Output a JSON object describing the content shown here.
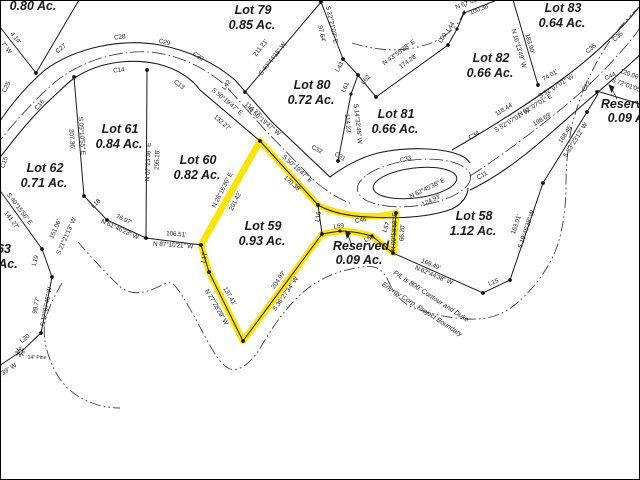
{
  "map": {
    "background_color": "#ffffff",
    "line_color": "#1b1b1b",
    "highlight_color": "#ffe400",
    "contour_color": "#404040",
    "highlighted_parcel": {
      "name": "Lot 59",
      "acreage": "0.93 Ac."
    },
    "parcels": [
      {
        "name": "(partial)",
        "acreage": "0.80 Ac."
      },
      {
        "name": "Lot 79",
        "acreage": "0.85 Ac."
      },
      {
        "name": "Lot 80",
        "acreage": "0.72 Ac."
      },
      {
        "name": "Lot 81",
        "acreage": "0.66 Ac."
      },
      {
        "name": "Lot 82",
        "acreage": "0.66 Ac."
      },
      {
        "name": "Lot 83",
        "acreage": "0.64 Ac."
      },
      {
        "name": "Lot 61",
        "acreage": "0.84 Ac."
      },
      {
        "name": "Lot 62",
        "acreage": "0.71 Ac."
      },
      {
        "name": "Lot 63 (partial)",
        "acreage": ""
      },
      {
        "name": "Lot 60",
        "acreage": "0.82 Ac."
      },
      {
        "name": "Lot 59",
        "acreage": "0.93 Ac."
      },
      {
        "name": "Lot 58",
        "acreage": "1.12 Ac."
      },
      {
        "name": "Reserved",
        "acreage": "0.09 Ac."
      },
      {
        "name": "Reserved",
        "acreage": "0.09 Ac."
      }
    ],
    "boundary_note_line1": "P/L is 800' Contour and Duke",
    "boundary_note_line2": "Energy Corp. Project Boundary",
    "tree_label": "14\" Pine"
  },
  "labels": [
    {
      "n": "lot-78-acreage",
      "t": "0.80 Ac.",
      "x": 33,
      "y": 10,
      "r": 0,
      "c": "lot"
    },
    {
      "n": "lot-79-name",
      "t": "Lot 79",
      "x": 253,
      "y": 14,
      "r": 0,
      "c": "lot"
    },
    {
      "n": "lot-79-acreage",
      "t": "0.85 Ac.",
      "x": 252,
      "y": 29,
      "r": 0,
      "c": "lot"
    },
    {
      "n": "lot-80-name",
      "t": "Lot 80",
      "x": 312,
      "y": 89,
      "r": 0,
      "c": "lot"
    },
    {
      "n": "lot-80-acreage",
      "t": "0.72 Ac.",
      "x": 311,
      "y": 104,
      "r": 0,
      "c": "lot"
    },
    {
      "n": "lot-81-name",
      "t": "Lot 81",
      "x": 396,
      "y": 118,
      "r": 0,
      "c": "lot"
    },
    {
      "n": "lot-81-acreage",
      "t": "0.66 Ac.",
      "x": 395,
      "y": 133,
      "r": 0,
      "c": "lot"
    },
    {
      "n": "lot-82-name",
      "t": "Lot 82",
      "x": 491,
      "y": 62,
      "r": 0,
      "c": "lot"
    },
    {
      "n": "lot-82-acreage",
      "t": "0.66 Ac.",
      "x": 490,
      "y": 77,
      "r": 0,
      "c": "lot"
    },
    {
      "n": "lot-83-name",
      "t": "Lot 83",
      "x": 563,
      "y": 12,
      "r": 0,
      "c": "lot"
    },
    {
      "n": "lot-83-acreage",
      "t": "0.64 Ac.",
      "x": 562,
      "y": 27,
      "r": 0,
      "c": "lot"
    },
    {
      "n": "lot-61-name",
      "t": "Lot 61",
      "x": 120,
      "y": 133,
      "r": 0,
      "c": "lot"
    },
    {
      "n": "lot-61-acreage",
      "t": "0.84 Ac.",
      "x": 119,
      "y": 148,
      "r": 0,
      "c": "lot"
    },
    {
      "n": "lot-62-name",
      "t": "Lot 62",
      "x": 45,
      "y": 172,
      "r": 0,
      "c": "lot"
    },
    {
      "n": "lot-62-acreage",
      "t": "0.71 Ac.",
      "x": 44,
      "y": 187,
      "r": 0,
      "c": "lot"
    },
    {
      "n": "lot-63-name-partial",
      "t": "63",
      "x": 4,
      "y": 253,
      "r": 0,
      "c": "lot"
    },
    {
      "n": "lot-63-acreage-partial",
      "t": "Ac.",
      "x": 8,
      "y": 268,
      "r": 0,
      "c": "lot"
    },
    {
      "n": "lot-60-name",
      "t": "Lot 60",
      "x": 198,
      "y": 164,
      "r": 0,
      "c": "lot"
    },
    {
      "n": "lot-60-acreage",
      "t": "0.82 Ac.",
      "x": 197,
      "y": 179,
      "r": 0,
      "c": "lot"
    },
    {
      "n": "lot-59-name",
      "t": "Lot 59",
      "x": 263,
      "y": 230,
      "r": 0,
      "c": "lot"
    },
    {
      "n": "lot-59-acreage",
      "t": "0.93 Ac.",
      "x": 262,
      "y": 245,
      "r": 0,
      "c": "lot"
    },
    {
      "n": "lot-58-name",
      "t": "Lot 58",
      "x": 474,
      "y": 220,
      "r": 0,
      "c": "lot"
    },
    {
      "n": "lot-58-acreage",
      "t": "1.12 Ac.",
      "x": 473,
      "y": 235,
      "r": 0,
      "c": "lot"
    },
    {
      "n": "reserved-center-name",
      "t": "Reserved",
      "x": 361,
      "y": 250,
      "r": 0,
      "c": "lot"
    },
    {
      "n": "reserved-center-acreage",
      "t": "0.09 Ac.",
      "x": 359,
      "y": 264,
      "r": 0,
      "c": "lot"
    },
    {
      "n": "reserved-right-name",
      "t": "Reserved",
      "x": 629,
      "y": 108,
      "r": 0,
      "c": "lot"
    },
    {
      "n": "reserved-right-acreage",
      "t": "0.09 Ac.",
      "x": 631,
      "y": 122,
      "r": 0,
      "c": "lot"
    },
    {
      "n": "curve-ref-c25",
      "t": "C25",
      "x": 8,
      "y": 88,
      "r": -62,
      "c": "sm"
    },
    {
      "n": "curve-ref-c27",
      "t": "C27",
      "x": 62,
      "y": 50,
      "r": -38,
      "c": "sm"
    },
    {
      "n": "curve-ref-c28",
      "t": "C28",
      "x": 120,
      "y": 39,
      "r": -8,
      "c": "sm"
    },
    {
      "n": "curve-ref-c29",
      "t": "C29",
      "x": 164,
      "y": 44,
      "r": 14,
      "c": "sm"
    },
    {
      "n": "curve-ref-c30",
      "t": "C30",
      "x": 197,
      "y": 58,
      "r": 33,
      "c": "sm"
    },
    {
      "n": "curve-ref-c16",
      "t": "C16",
      "x": 41,
      "y": 106,
      "r": -52,
      "c": "sm"
    },
    {
      "n": "curve-ref-c14",
      "t": "C14",
      "x": 119,
      "y": 72,
      "r": -6,
      "c": "sm"
    },
    {
      "n": "curve-ref-c13",
      "t": "C13",
      "x": 178,
      "y": 86,
      "r": 38,
      "c": "sm"
    },
    {
      "n": "curve-ref-c15",
      "t": "C15",
      "x": 6,
      "y": 163,
      "r": -72,
      "c": "sm"
    },
    {
      "n": "curve-ref-c32",
      "t": "C32",
      "x": 316,
      "y": 151,
      "r": 28,
      "c": "sm"
    },
    {
      "n": "curve-ref-c31",
      "t": "C31",
      "x": 339,
      "y": 158,
      "r": 32,
      "c": "sm"
    },
    {
      "n": "curve-ref-c33",
      "t": "C33",
      "x": 406,
      "y": 161,
      "r": -14,
      "c": "sm"
    },
    {
      "n": "curve-ref-c34",
      "t": "C34",
      "x": 475,
      "y": 137,
      "r": -32,
      "c": "sm"
    },
    {
      "n": "curve-ref-c35",
      "t": "C35",
      "x": 592,
      "y": 50,
      "r": -40,
      "c": "sm"
    },
    {
      "n": "curve-ref-c36",
      "t": "C36",
      "x": 619,
      "y": 38,
      "r": -42,
      "c": "sm"
    },
    {
      "n": "curve-ref-c11",
      "t": "C11",
      "x": 483,
      "y": 177,
      "r": -30,
      "c": "sm"
    },
    {
      "n": "curve-ref-c12",
      "t": "C12",
      "x": 588,
      "y": 87,
      "r": -58,
      "c": "sm"
    },
    {
      "n": "curve-ref-c44",
      "t": "C44",
      "x": 611,
      "y": 78,
      "r": -25,
      "c": "sm"
    },
    {
      "n": "curve-ref-c46",
      "t": "C46",
      "x": 361,
      "y": 222,
      "r": -10,
      "c": "sm"
    },
    {
      "n": "line-ref-l42",
      "t": "L42",
      "x": 228,
      "y": 86,
      "r": -55,
      "c": "sm"
    },
    {
      "n": "line-ref-l43",
      "t": "L43",
      "x": 341,
      "y": 68,
      "r": -58,
      "c": "sm"
    },
    {
      "n": "line-ref-l61",
      "t": "L61",
      "x": 347,
      "y": 88,
      "r": -68,
      "c": "sm"
    },
    {
      "n": "line-ref-l62",
      "t": "L62",
      "x": 367,
      "y": 81,
      "r": -48,
      "c": "sm"
    },
    {
      "n": "line-ref-l60",
      "t": "L60",
      "x": 444,
      "y": 39,
      "r": -58,
      "c": "sm"
    },
    {
      "n": "line-ref-l44",
      "t": "L44",
      "x": 452,
      "y": 28,
      "r": -58,
      "c": "sm"
    },
    {
      "n": "line-ref-l16",
      "t": "L16",
      "x": 320,
      "y": 217,
      "r": -80,
      "c": "sm"
    },
    {
      "n": "line-ref-l59",
      "t": "L59",
      "x": 339,
      "y": 228,
      "r": -8,
      "c": "sm"
    },
    {
      "n": "line-ref-l58",
      "t": "L58",
      "x": 370,
      "y": 240,
      "r": -28,
      "c": "sm"
    },
    {
      "n": "line-ref-l57",
      "t": "L57",
      "x": 388,
      "y": 228,
      "r": -68,
      "c": "sm"
    },
    {
      "n": "line-ref-l15",
      "t": "L15",
      "x": 494,
      "y": 284,
      "r": -22,
      "c": "sm"
    },
    {
      "n": "line-ref-l17",
      "t": "L17",
      "x": 206,
      "y": 258,
      "r": -80,
      "c": "sm"
    },
    {
      "n": "line-ref-l18",
      "t": "L18",
      "x": 97,
      "y": 205,
      "r": -42,
      "c": "sm"
    },
    {
      "n": "line-ref-l19",
      "t": "L19",
      "x": 37,
      "y": 261,
      "r": -74,
      "c": "sm"
    },
    {
      "n": "line-ref-l20",
      "t": "L20",
      "x": 26,
      "y": 340,
      "r": -38,
      "c": "sm"
    },
    {
      "n": "bearing",
      "t": "S 05°10'55\" E",
      "x": 80,
      "y": 136,
      "r": 86,
      "c": "sm"
    },
    {
      "n": "distance",
      "t": "207.36'",
      "x": 70,
      "y": 139,
      "r": 86,
      "c": "sm"
    },
    {
      "n": "bearing",
      "t": "N 07°23'38\" E",
      "x": 150,
      "y": 162,
      "r": -88,
      "c": "sm"
    },
    {
      "n": "distance",
      "t": "295.18'",
      "x": 159,
      "y": 160,
      "r": -88,
      "c": "sm"
    },
    {
      "n": "distance",
      "t": "211.21'",
      "x": 262,
      "y": 49,
      "r": -52,
      "c": "sm"
    },
    {
      "n": "bearing",
      "t": "S 40°44'15\" W",
      "x": 274,
      "y": 60,
      "r": -52,
      "c": "sm"
    },
    {
      "n": "distance",
      "t": "97.64'",
      "x": 320,
      "y": 34,
      "r": 78,
      "c": "sm"
    },
    {
      "n": "bearing",
      "t": "S 22°21'07\" E",
      "x": 330,
      "y": 25,
      "r": 78,
      "c": "sm"
    },
    {
      "n": "bearing",
      "t": "N 43°55'38\" E",
      "x": 400,
      "y": 54,
      "r": -36,
      "c": "sm"
    },
    {
      "n": "distance",
      "t": "174.28'",
      "x": 409,
      "y": 63,
      "r": -36,
      "c": "sm"
    },
    {
      "n": "distance",
      "t": "114.23'",
      "x": 346,
      "y": 124,
      "r": 84,
      "c": "sm"
    },
    {
      "n": "bearing",
      "t": "S 14°32'46\" W",
      "x": 356,
      "y": 124,
      "r": 84,
      "c": "sm"
    },
    {
      "n": "bearing",
      "t": "S 50°19'47\" E",
      "x": 226,
      "y": 103,
      "r": 40,
      "c": "sm"
    },
    {
      "n": "distance",
      "t": "132.27'",
      "x": 221,
      "y": 124,
      "r": 40,
      "c": "sm"
    },
    {
      "n": "distance",
      "t": "114.77'",
      "x": 252,
      "y": 111,
      "r": 40,
      "c": "sm"
    },
    {
      "n": "bearing",
      "t": "N 50°19'47\" W",
      "x": 263,
      "y": 123,
      "r": 40,
      "c": "sm"
    },
    {
      "n": "bearing",
      "t": "S 50°19'47\" E",
      "x": 296,
      "y": 170,
      "r": 42,
      "c": "sm"
    },
    {
      "n": "distance",
      "t": "170.38'",
      "x": 291,
      "y": 185,
      "r": 42,
      "c": "sm"
    },
    {
      "n": "bearing",
      "t": "N 26°16'36\" E",
      "x": 224,
      "y": 191,
      "r": -63,
      "c": "sm"
    },
    {
      "n": "distance",
      "t": "201.42'",
      "x": 237,
      "y": 202,
      "r": -63,
      "c": "sm"
    },
    {
      "n": "distance",
      "t": "137.41'",
      "x": 228,
      "y": 297,
      "r": 60,
      "c": "sm"
    },
    {
      "n": "bearing",
      "t": "N 27°28'29\" W",
      "x": 215,
      "y": 308,
      "r": 60,
      "c": "sm"
    },
    {
      "n": "distance",
      "t": "204.97'",
      "x": 280,
      "y": 281,
      "r": -55,
      "c": "sm"
    },
    {
      "n": "bearing",
      "t": "S 36°27'34\" W",
      "x": 287,
      "y": 295,
      "r": -55,
      "c": "sm"
    },
    {
      "n": "distance",
      "t": "169.49'",
      "x": 430,
      "y": 266,
      "r": 23,
      "c": "sm"
    },
    {
      "n": "bearing",
      "t": "N 62°44'38\" W",
      "x": 433,
      "y": 277,
      "r": 23,
      "c": "sm"
    },
    {
      "n": "bearing",
      "t": "N 00°58'58\" E",
      "x": 396,
      "y": 232,
      "r": -87,
      "c": "sm"
    },
    {
      "n": "distance",
      "t": "66.20'",
      "x": 404,
      "y": 233,
      "r": -87,
      "c": "sm"
    },
    {
      "n": "bearing",
      "t": "N 62°45'38\" E",
      "x": 428,
      "y": 190,
      "r": -26,
      "c": "sm"
    },
    {
      "n": "distance",
      "t": "124.93'",
      "x": 432,
      "y": 202,
      "r": -26,
      "c": "sm"
    },
    {
      "n": "distance",
      "t": "163.01'",
      "x": 518,
      "y": 225,
      "r": -71,
      "c": "sm"
    },
    {
      "n": "bearing",
      "t": "S 19°45'38\" W",
      "x": 528,
      "y": 230,
      "r": -71,
      "c": "sm"
    },
    {
      "n": "distance",
      "t": "168.45'",
      "x": 567,
      "y": 135,
      "r": -58,
      "c": "sm"
    },
    {
      "n": "bearing",
      "t": "S 33°23'12\" W",
      "x": 577,
      "y": 141,
      "r": -58,
      "c": "sm"
    },
    {
      "n": "distance",
      "t": "118.44'",
      "x": 505,
      "y": 111,
      "r": -31,
      "c": "sm"
    },
    {
      "n": "bearing",
      "t": "S 52°07'01\" W",
      "x": 513,
      "y": 122,
      "r": -31,
      "c": "sm"
    },
    {
      "n": "bearing",
      "t": "N 52°07'01\" E",
      "x": 536,
      "y": 107,
      "r": -31,
      "c": "sm"
    },
    {
      "n": "distance",
      "t": "198.69'",
      "x": 543,
      "y": 121,
      "r": -31,
      "c": "sm"
    },
    {
      "n": "distance",
      "t": "74.01'",
      "x": 551,
      "y": 77,
      "r": -31,
      "c": "sm"
    },
    {
      "n": "bearing",
      "t": "S 52°07'01\" W",
      "x": 557,
      "y": 88,
      "r": -31,
      "c": "sm"
    },
    {
      "n": "distance",
      "t": "120.06'",
      "x": 629,
      "y": 76,
      "r": 20,
      "c": "sm"
    },
    {
      "n": "bearing",
      "t": "S 72°01'05\" E",
      "x": 629,
      "y": 88,
      "r": 20,
      "c": "sm"
    },
    {
      "n": "distance",
      "t": "183.90'",
      "x": 528,
      "y": 44,
      "r": 74,
      "c": "sm"
    },
    {
      "n": "bearing",
      "t": "N 16°13'49\" W",
      "x": 517,
      "y": 49,
      "r": 74,
      "c": "sm"
    },
    {
      "n": "distance",
      "t": "100.38'",
      "x": 480,
      "y": 11,
      "r": -21,
      "c": "sm"
    },
    {
      "n": "bearing",
      "t": "N 67°05' E",
      "x": 470,
      "y": 4,
      "r": -21,
      "c": "sm"
    },
    {
      "n": "distance",
      "t": "106.51'",
      "x": 176,
      "y": 236,
      "r": 4,
      "c": "sm"
    },
    {
      "n": "bearing",
      "t": "N 87°10'21\" W",
      "x": 173,
      "y": 247,
      "r": 4,
      "c": "sm"
    },
    {
      "n": "distance",
      "t": "76.97'",
      "x": 123,
      "y": 221,
      "r": 25,
      "c": "sm"
    },
    {
      "n": "bearing",
      "t": "N 61°46'23\" W",
      "x": 119,
      "y": 231,
      "r": 25,
      "c": "sm"
    },
    {
      "n": "distance",
      "t": "151.06'",
      "x": 57,
      "y": 230,
      "r": -66,
      "c": "sm"
    },
    {
      "n": "bearing",
      "t": "S 21°21'13\" W",
      "x": 68,
      "y": 237,
      "r": -66,
      "c": "sm"
    },
    {
      "n": "bearing",
      "t": "S 40°15'56\" E",
      "x": 18,
      "y": 210,
      "r": 53,
      "c": "sm"
    },
    {
      "n": "distance",
      "t": "141.27'",
      "x": 10,
      "y": 221,
      "r": 53,
      "c": "sm"
    },
    {
      "n": "distance",
      "t": "99.77'",
      "x": 38,
      "y": 306,
      "r": -79,
      "c": "sm"
    },
    {
      "n": "bearing",
      "t": "S 12°07'45\" W",
      "x": 48,
      "y": 307,
      "r": -79,
      "c": "sm"
    },
    {
      "n": "distance-partial",
      "t": "4.14'",
      "x": 14,
      "y": 39,
      "r": 51,
      "c": "sm"
    },
    {
      "n": "bearing-partial",
      "t": "7\" W",
      "x": 5,
      "y": 49,
      "r": 51,
      "c": "sm"
    },
    {
      "n": "bearing-partial",
      "t": "4'39\" W",
      "x": 8,
      "y": 372,
      "r": -33,
      "c": "sm"
    },
    {
      "n": "tree-label",
      "t": "14\" Pine",
      "x": 37,
      "y": 359,
      "r": 0,
      "c": "tiny"
    },
    {
      "n": "boundary-note-line1",
      "t": "P/L is 800' Contour and Duke",
      "x": 430,
      "y": 298,
      "r": 33,
      "c": "pl"
    },
    {
      "n": "boundary-note-line2",
      "t": "Energy Corp. Project Boundary",
      "x": 421,
      "y": 311,
      "r": 33,
      "c": "pl"
    }
  ]
}
